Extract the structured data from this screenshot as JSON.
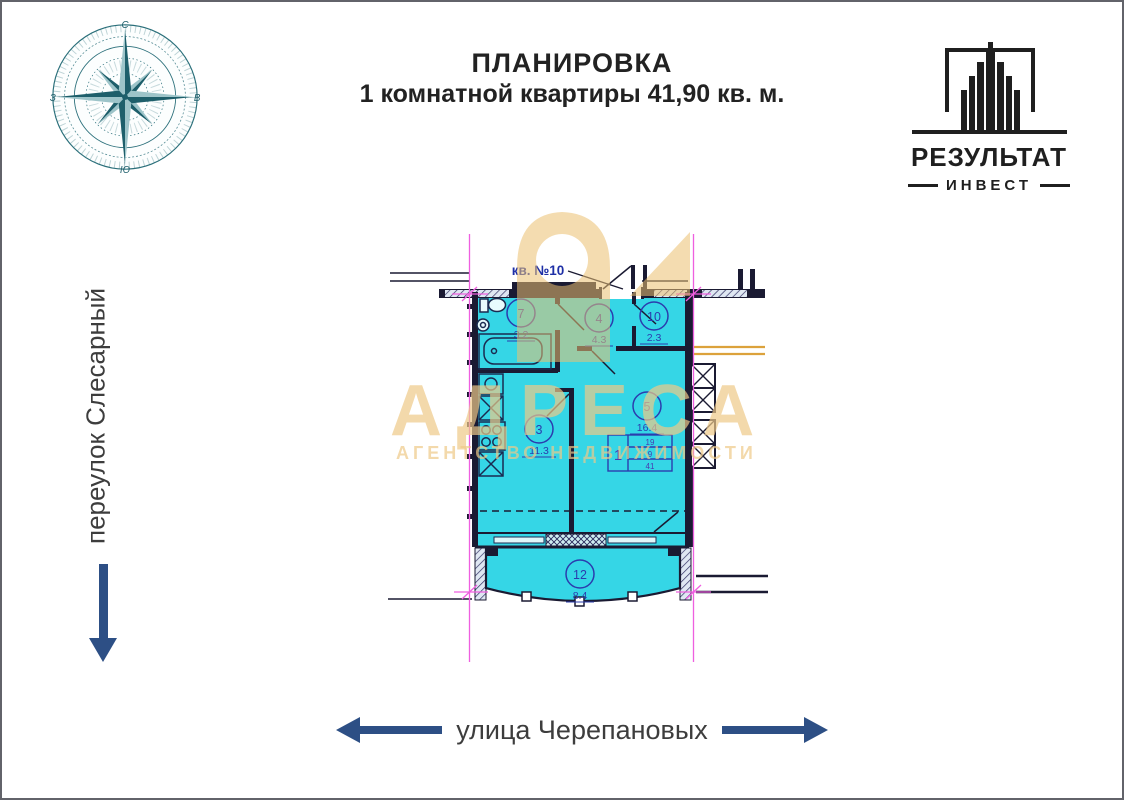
{
  "page": {
    "background": "#ffffff",
    "frame_color": "#62636a"
  },
  "header": {
    "title_line1": "ПЛАНИРОВКА",
    "title_line2": "1 комнатной квартиры 41,90 кв. м."
  },
  "compass": {
    "north": "С",
    "south": "Ю",
    "west": "З",
    "east": "В",
    "color": "#2a6f7a"
  },
  "brand": {
    "name": "РЕЗУЛЬТАТ",
    "subname": "ИНВЕСТ",
    "color": "#1f1f1f"
  },
  "streets": {
    "left_label": "переулок Слесарный",
    "bottom_label": "улица Черепановых",
    "text_color": "#3d3d3d",
    "arrow_color": "#2d4f85"
  },
  "watermark": {
    "title": "АДРЕСА",
    "subtitle": "АГЕНТСТВО НЕДВИЖИМОСТИ",
    "color": "#ecc987"
  },
  "floor_plan": {
    "apartment_label": "кв. №10",
    "colors": {
      "fill": "#35d6e6",
      "walls": "#1a1a32",
      "axes": "#ef5fe0",
      "labels": "#2b3cae",
      "utility_lines": "#dca23c"
    },
    "rooms": [
      {
        "number": "7",
        "area": "3.2"
      },
      {
        "number": "4",
        "area": "4.3"
      },
      {
        "number": "10",
        "area": "2.3"
      },
      {
        "number": "3",
        "area": "11.3"
      },
      {
        "number": "5",
        "area": "16.4"
      },
      {
        "number": "12",
        "area": "8.4"
      }
    ],
    "stamp": {
      "rooms_count": "1",
      "rows": [
        "19",
        "9",
        "41"
      ]
    }
  }
}
